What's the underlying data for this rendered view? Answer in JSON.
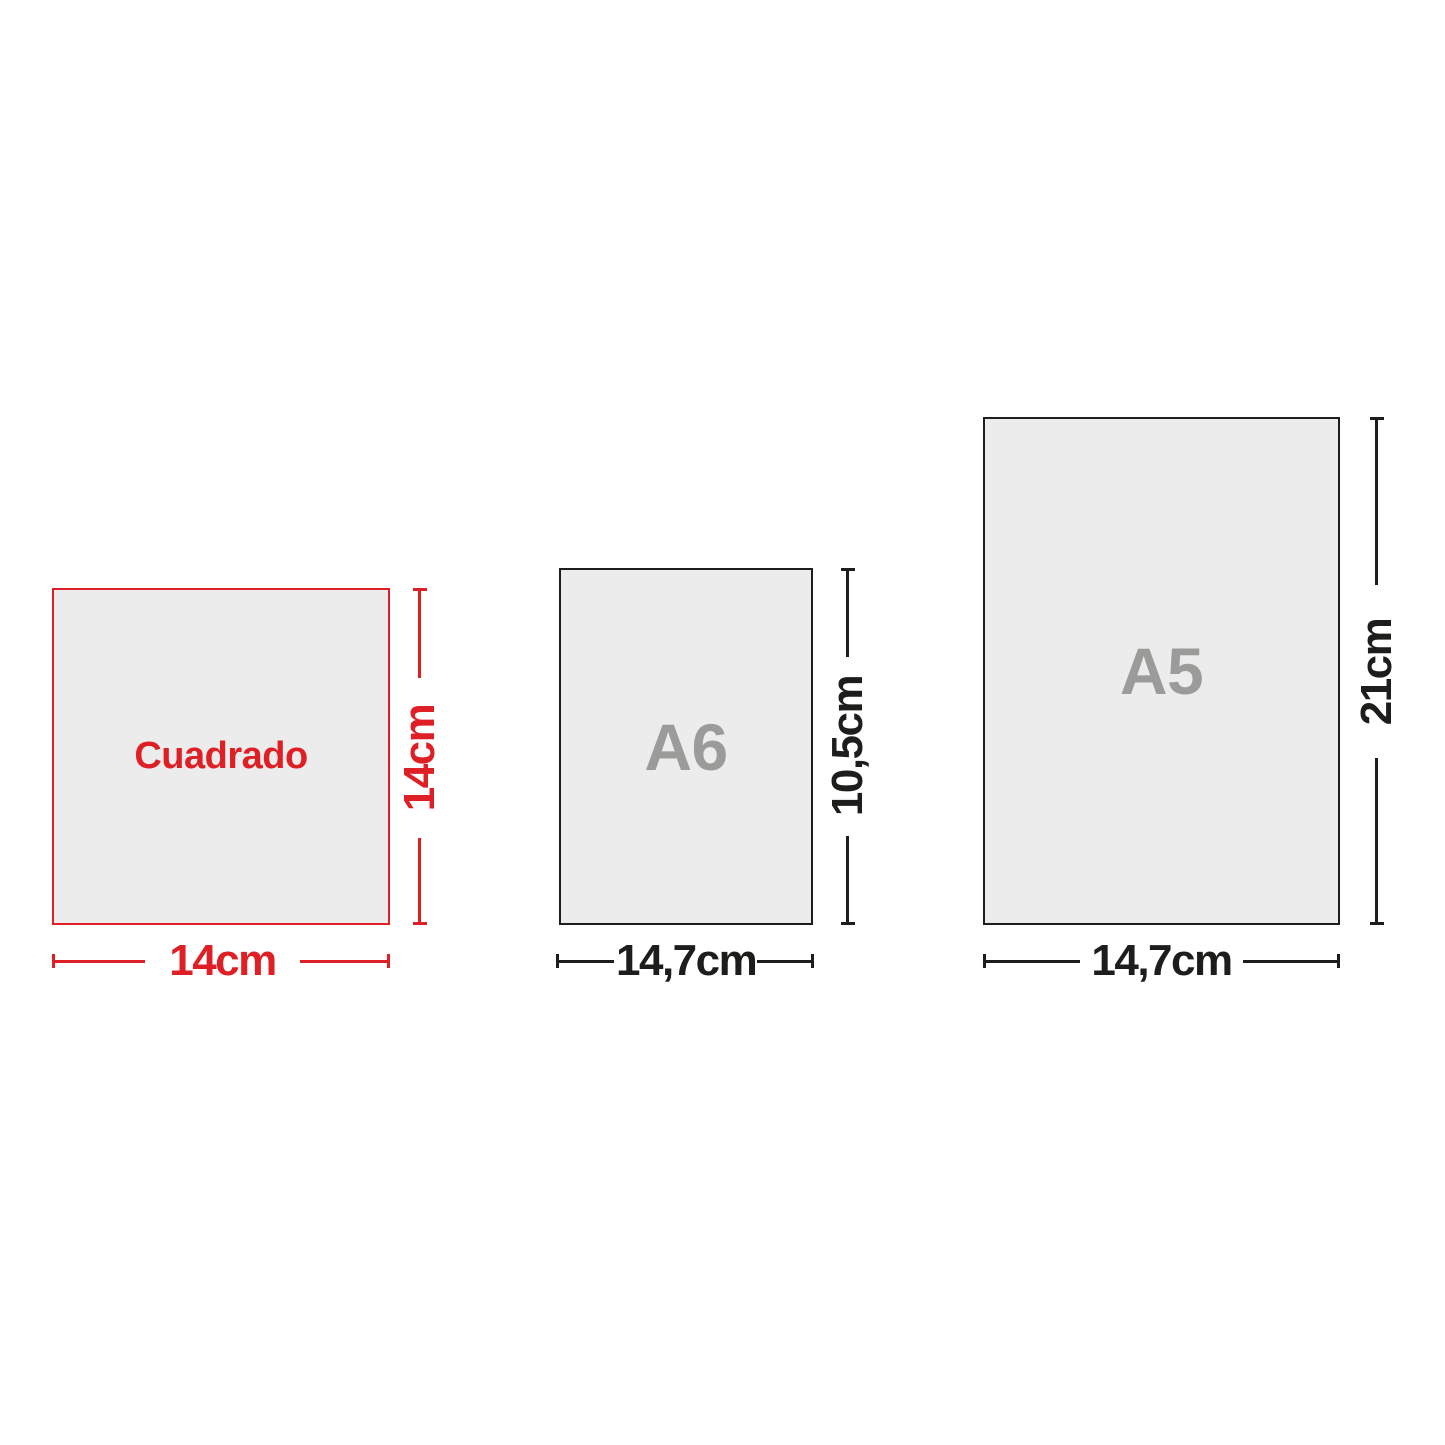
{
  "colors": {
    "red": "#df1f26",
    "dark": "#1d1d1b",
    "gray": "#9b9b9a",
    "paper_fill": "#ececec",
    "background": "#ffffff"
  },
  "papers": {
    "cuadrado": {
      "label": "Cuadrado",
      "width": "14cm",
      "height": "14cm"
    },
    "a6": {
      "label": "A6",
      "width": "14,7cm",
      "height": "10,5cm"
    },
    "a5": {
      "label": "A5",
      "width": "14,7cm",
      "height": "21cm"
    }
  }
}
